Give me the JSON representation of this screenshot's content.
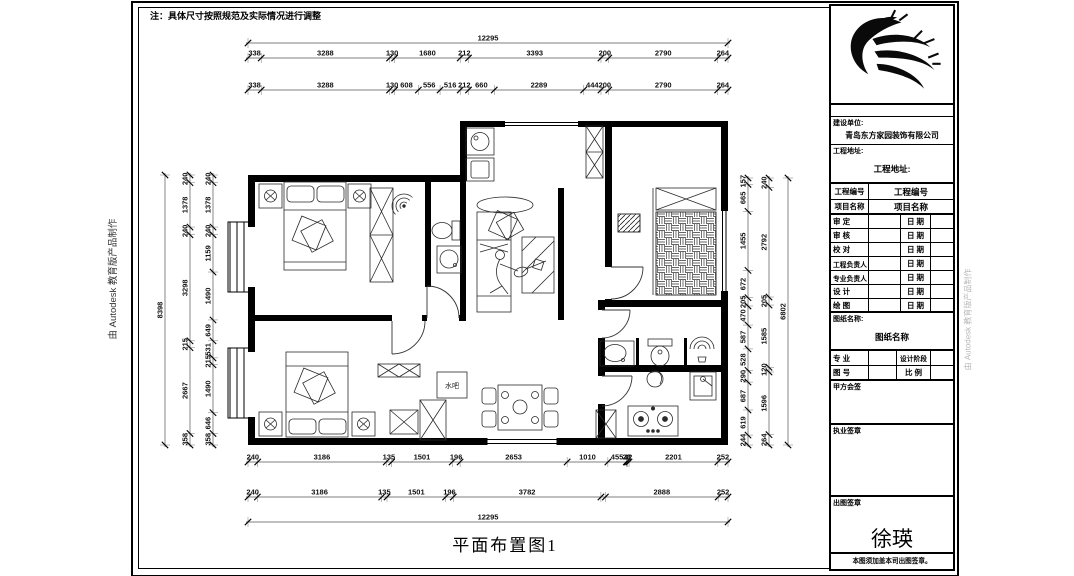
{
  "note": "注：具体尺寸按照规范及实际情况进行调整",
  "plan_title": "平面布置图1",
  "watermark": "由 Autodesk 教育版产品制作",
  "plan_labels": {
    "water_bar": "水吧"
  },
  "title_block": {
    "company_label": "建设单位:",
    "company": "青岛东方家园装饰有限公司",
    "address_label": "工程地址:",
    "address_value": "工程地址:",
    "project_no_label": "工程编号",
    "project_no_value": "工程编号",
    "project_name_label": "项目名称",
    "project_name_value": "项目名称",
    "rows": [
      {
        "label": "审 定",
        "date_label": "日 期"
      },
      {
        "label": "审 核",
        "date_label": "日 期"
      },
      {
        "label": "校 对",
        "date_label": "日 期"
      },
      {
        "label": "工程负责人",
        "date_label": "日 期"
      },
      {
        "label": "专业负责人",
        "date_label": "日 期"
      },
      {
        "label": "设 计",
        "date_label": "日 期"
      },
      {
        "label": "绘 图",
        "date_label": "日 期"
      }
    ],
    "drawing_name_label": "图纸名称:",
    "drawing_name_value": "图纸名称",
    "major_label": "专 业",
    "stage_label": "设计阶段",
    "fig_no_label": "图 号",
    "scale_label": "比 例",
    "party_a_label": "甲方会签",
    "practice_seal_label": "执业签章",
    "issue_seal_label": "出图签章",
    "signature": "徐瑛",
    "footer_note": "本图须加盖本司出图签章。"
  },
  "dimensions": {
    "top_total": {
      "values": [
        12295
      ]
    },
    "top_row1": {
      "values": [
        338,
        3288,
        130,
        1680,
        212,
        3393,
        200,
        2790,
        264
      ]
    },
    "top_row2": {
      "values": [
        338,
        3288,
        130,
        608,
        556,
        516,
        212,
        660,
        2289,
        444,
        200,
        2790,
        264
      ]
    },
    "bottom_row1": {
      "values": [
        240,
        3186,
        135,
        1501,
        196,
        2653,
        1010,
        455,
        28,
        42,
        2201,
        252
      ]
    },
    "bottom_row2": {
      "values": [
        240,
        3186,
        135,
        1501,
        196,
        3782,
        2888,
        252
      ]
    },
    "bottom_total": {
      "values": [
        12295
      ]
    },
    "left_total": {
      "values": [
        8398
      ]
    },
    "left_mid": {
      "values": [
        240,
        1378,
        240,
        3298,
        215,
        2667,
        358
      ]
    },
    "left_inner": {
      "values": [
        240,
        1378,
        240,
        1159,
        1490,
        649,
        531,
        215,
        1490,
        646,
        358
      ]
    },
    "right_inner": {
      "values": [
        157,
        665,
        1455,
        672,
        205,
        470,
        587,
        528,
        290,
        687,
        619,
        244
      ]
    },
    "right_mid": {
      "values": [
        240,
        2792,
        205,
        1585,
        120,
        1596,
        264
      ]
    },
    "right_total": {
      "values": [
        6802
      ]
    }
  }
}
